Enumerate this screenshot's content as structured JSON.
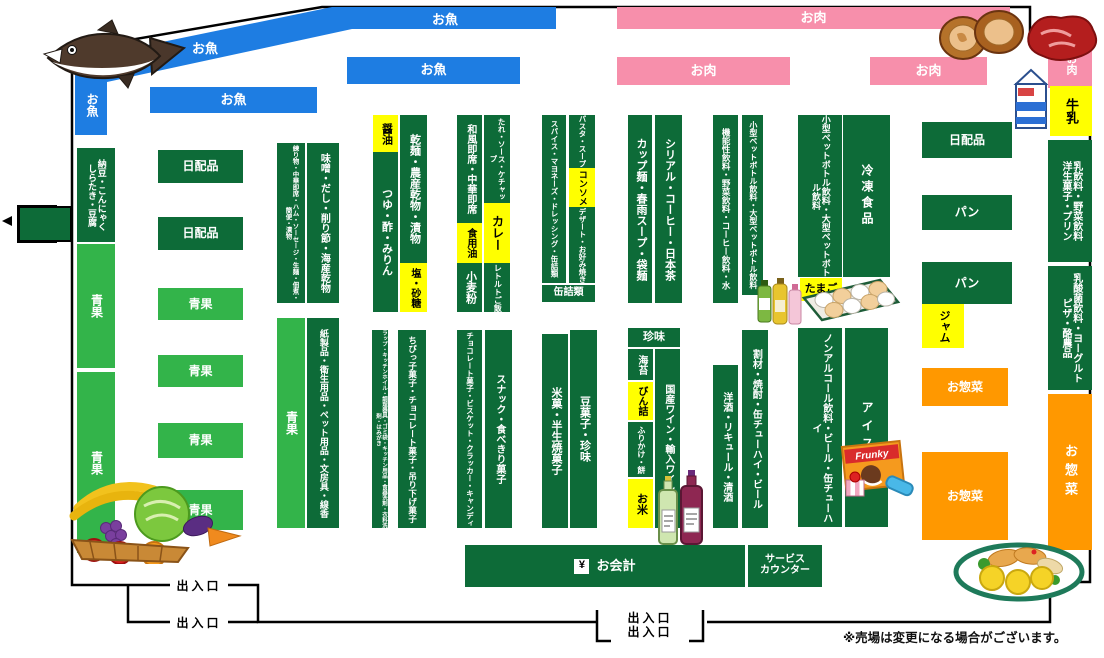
{
  "map_title": "スーパー売場マップ",
  "note": "※売場は変更になる場合がございます。",
  "colors": {
    "fish_blue": "#1e7de2",
    "meat_pink": "#f78fab",
    "aisle_dark_green": "#0d6b38",
    "produce_light_green": "#33b44a",
    "highlight_yellow": "#ffff00",
    "deli_orange": "#ff9800"
  },
  "labels": {
    "fish": "お魚",
    "meat": "お肉",
    "produce": "青果",
    "daily_goods": "日配品",
    "bread": "パン",
    "deli": "お惣菜",
    "milk": "牛乳",
    "egg": "たまご",
    "jam": "ジャム",
    "frozen": "冷凍食品",
    "ice": "アイス",
    "natto": "納豆・こんにゃく\nしらたき・豆腐",
    "neri": "練り物・中華即席・ハム・ソーセージ・生麺・佃煮・簡便・漬物",
    "miso": "味噌・だし・削り節・海産乾物",
    "paper": "紙製品・衛生用品・ペット用品・文房具・線香",
    "wrap": "ラップ・キッチンホイル・調理器具・ゴミ袋・キッチン用品・食器洗剤・衣料洗剤・はみがき",
    "shoyu": "醤油",
    "tsuyu": "つゆ・酢・みりん",
    "kanmen": "乾麺・農産乾物・漬物",
    "salt_sugar": "塩・砂糖",
    "wafu": "和風即席・中華即席",
    "cooking_oil": "食用油",
    "flour": "小麦粉",
    "tare": "たれ・ソース・ケチャップ",
    "curry": "カレー",
    "retort": "レトルトご飯",
    "spice": "スパイス・マヨネーズ・ドレッシング・缶詰類",
    "pasta": "パスタ・スープ",
    "consomme": "コンソメ",
    "dessert": "デザート・お好み焼き",
    "cans": "缶詰類",
    "cup_noodle": "カップ麺・春雨スープ・袋麺",
    "cereal": "シリアル・コーヒー・日本茶",
    "functional": "機能性飲料・野菜飲料・コーヒー飲料・水",
    "pet_bottle": "小型ペットボトル飲料・大型ペットボトル飲料",
    "milk_drink": "乳飲料・野菜飲料\n洋生菓子・プリン",
    "yogurt": "乳酸菌飲料・ヨーグルト\nピザ・酪農品",
    "chibikko": "ちびっ子菓子・チョコレート菓子・吊り下げ菓子",
    "choco": "チョコレート菓子・ビスケット・クラッカー・キャンディ",
    "snack": "スナック・食べきり菓子",
    "beika": "米菓・半生焼菓子",
    "mame": "豆菓子・珍味",
    "chinmi": "珍味",
    "nori": "海苔",
    "bin": "びん詰",
    "furikake": "ふりかけ・餅",
    "rice": "お米",
    "wine": "国産ワイン・輸入ワイン",
    "yoshu": "洋酒・リキュール・清酒",
    "warizai": "割材・焼酎・缶チューハイ・ビール",
    "nonalcohol": "ノンアルコール飲料・ビール・缶チューハイ",
    "entrance": "出入口",
    "service_counter": "サービス\nカウンター"
  },
  "checkout": {
    "symbol": "¥",
    "label": "お会計"
  },
  "brand": {
    "ice_cream_box": "Frunky"
  },
  "illustrations": [
    "tuna-fish",
    "meat",
    "milk-carton",
    "pet-bottles",
    "egg-pack",
    "wine-bottles",
    "ice-cream",
    "vegetable-basket",
    "deli-plate"
  ]
}
